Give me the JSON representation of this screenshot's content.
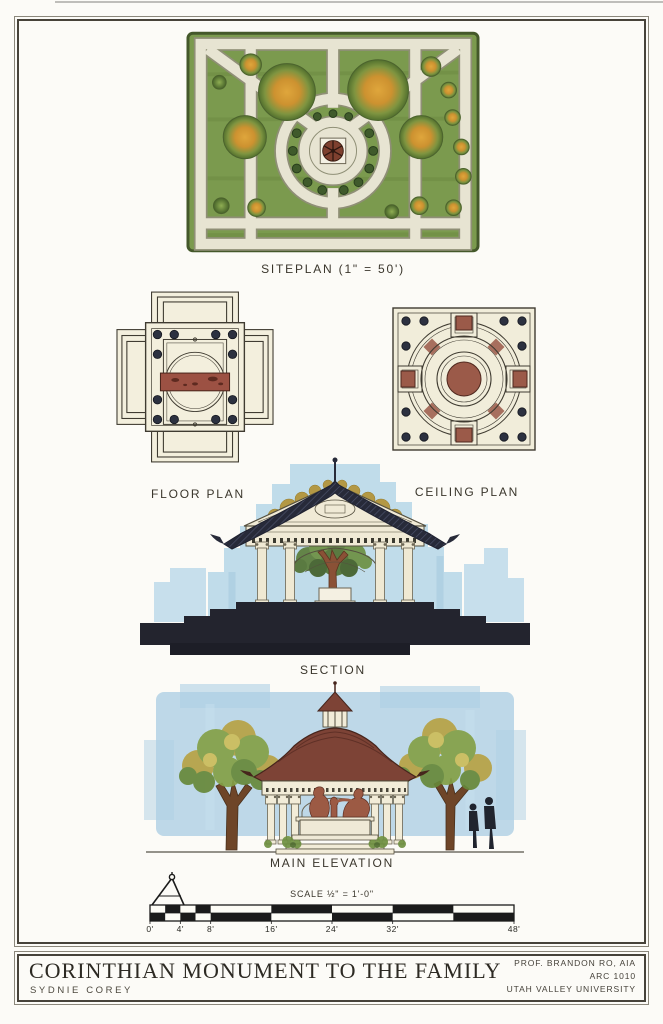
{
  "drawings": {
    "siteplan": {
      "label": "SITEPLAN (1\" = 50')"
    },
    "floorplan": {
      "label": "FLOOR PLAN"
    },
    "ceilingplan": {
      "label": "CEILING PLAN"
    },
    "section": {
      "label": "SECTION"
    },
    "elevation": {
      "label": "MAIN ELEVATION"
    }
  },
  "scale_bar": {
    "label": "SCALE ½\" = 1'-0\"",
    "ticks": [
      "0'",
      "4'",
      "8'",
      "16'",
      "24'",
      "32'",
      "48'"
    ]
  },
  "title_block": {
    "title": "CORINTHIAN MONUMENT TO THE FAMILY",
    "author": "SYDNIE COREY",
    "credits": [
      "PROF. BRANDON RO, AIA",
      "ARC 1010",
      "UTAH VALLEY UNIVERSITY"
    ]
  },
  "colors": {
    "paper": "#fcfbf7",
    "ink": "#3a362c",
    "site_green": "#7b9a4e",
    "path_cream": "#e7e4d2",
    "tree_orange": "#d29a38",
    "foliage_green": "#6d8f3f",
    "watercolor_blue": "#b3d4e6",
    "poche_dark": "#23242e",
    "roof_maroon": "#7d4336",
    "statue_brown": "#9c5a44",
    "plan_cream": "#f2eedd",
    "coffer_red": "#9b5a49"
  }
}
